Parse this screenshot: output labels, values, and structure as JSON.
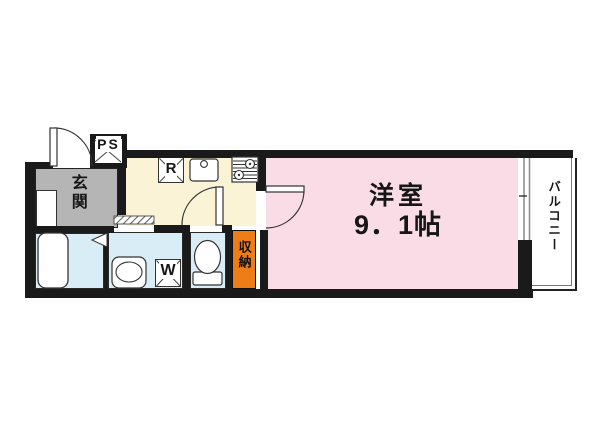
{
  "title": "floor-plan",
  "labels": {
    "genkan": "玄関",
    "ps": "PS",
    "refrigerator": "R",
    "washer": "W",
    "storage": "収納",
    "room_name": "洋室",
    "room_size": "9．1帖",
    "balcony": "バルコニー"
  },
  "colors": {
    "wall": "#1a1a1a",
    "genkan": "#b5b5b5",
    "kitchen": "#faf3d6",
    "western_room": "#f9dce6",
    "wet_area": "#d9edf6",
    "storage": "#ee7d18",
    "fixture_line": "#333333",
    "window_line": "#8f8f8f"
  }
}
